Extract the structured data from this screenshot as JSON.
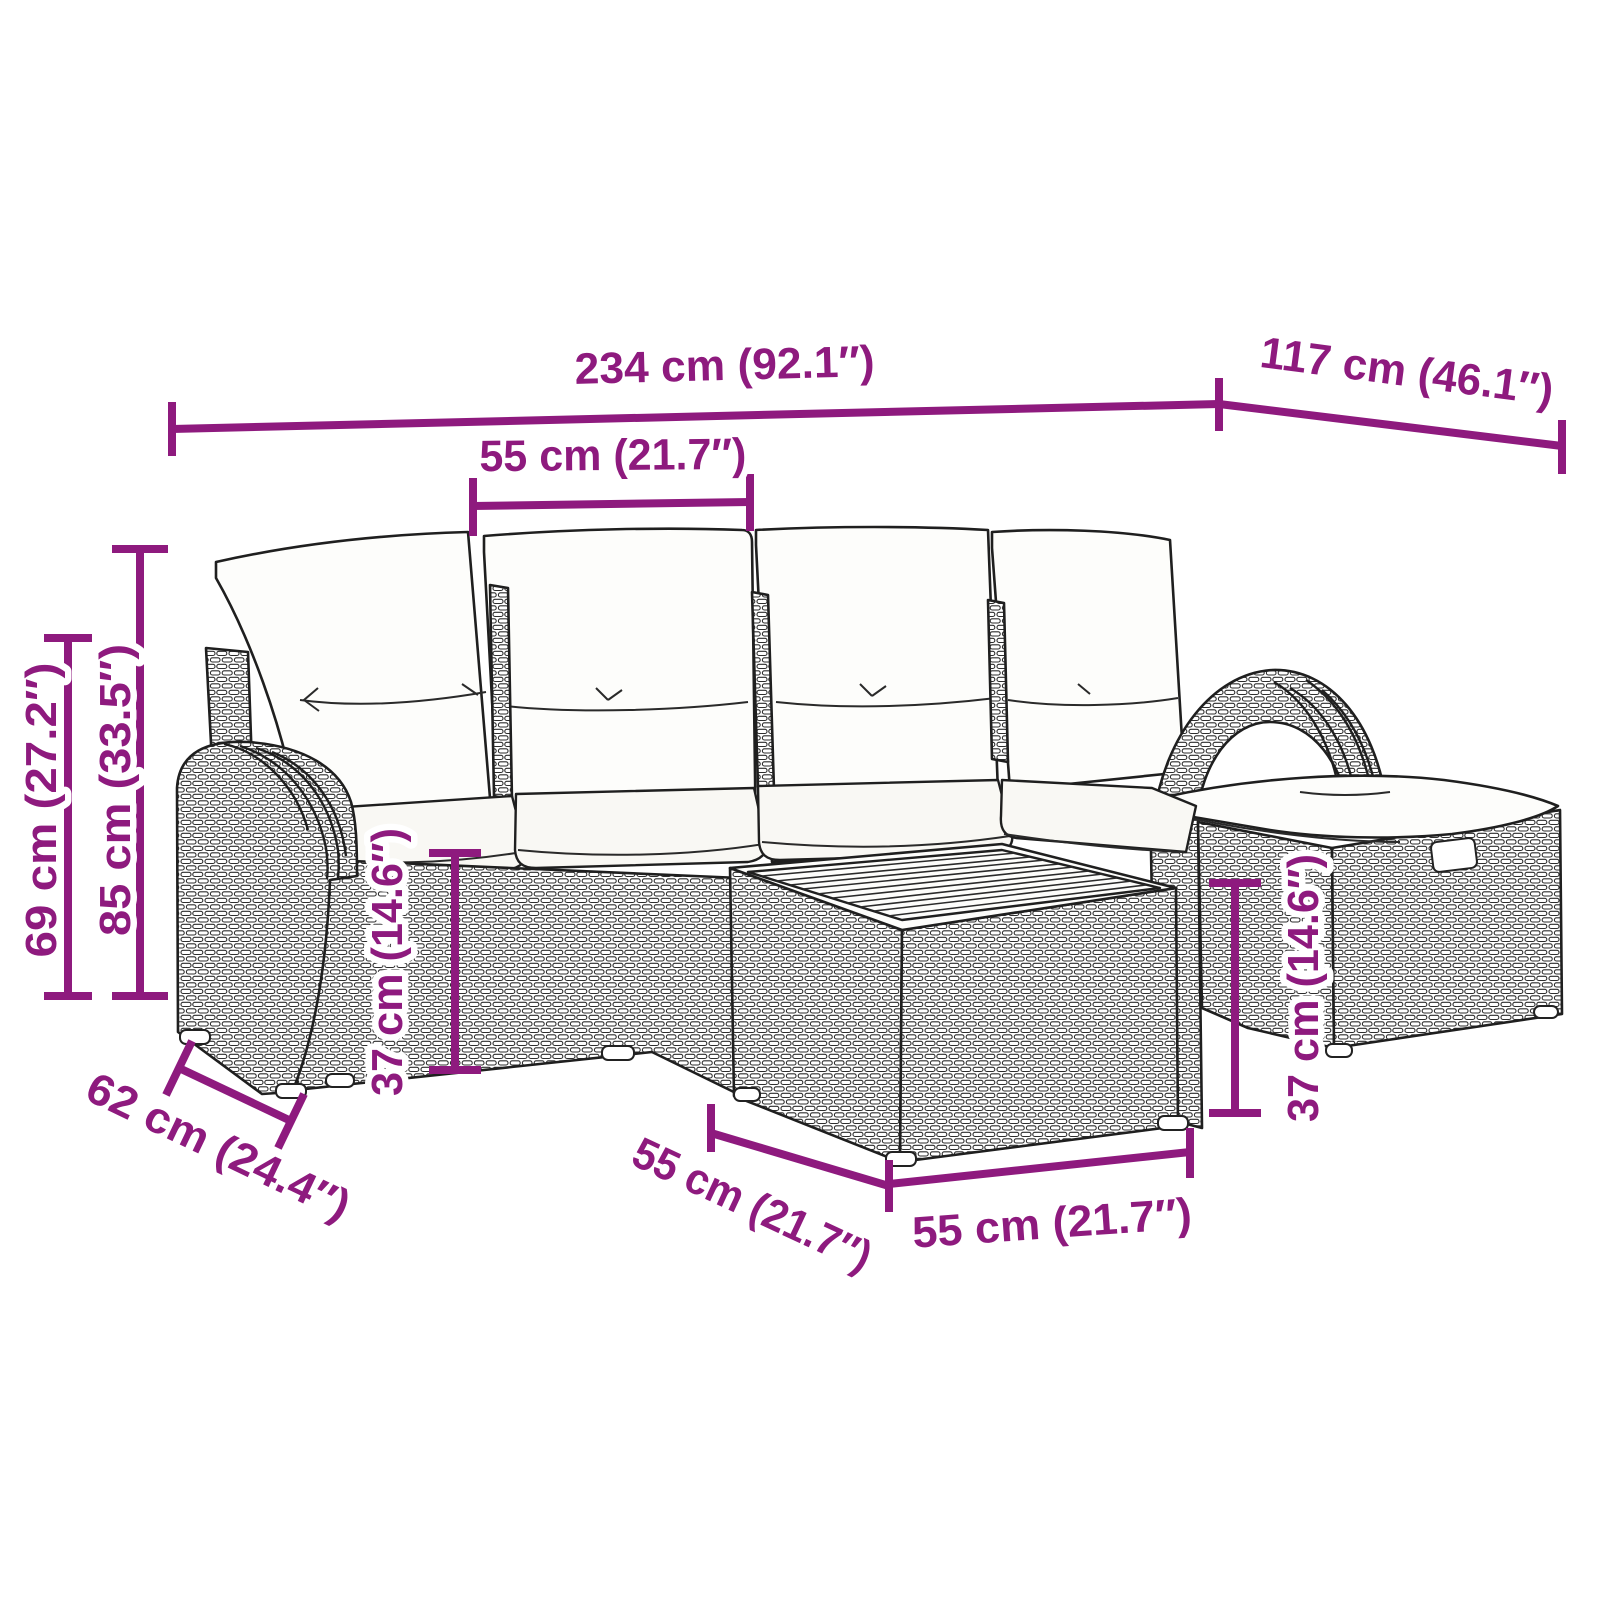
{
  "diagram": {
    "kind": "product-dimension-diagram",
    "subject": "rattan garden lounge set with cushions, ottoman and coffee table",
    "style": "black line-art drawing with magenta dimension annotations on white",
    "accent_color": "#8E1A7E",
    "line_color": "#1f1f1f",
    "background_color": "#ffffff"
  },
  "dims": {
    "total_width": "234 cm (92.1″)",
    "total_depth": "117 cm (46.1″)",
    "seat_width": "55 cm (21.7″)",
    "back_height": "85 cm (33.5″)",
    "arm_height": "69 cm (27.2″)",
    "seat_height_left": "37 cm (14.6″)",
    "arm_depth": "62 cm (24.4″)",
    "table_depth": "55 cm (21.7″)",
    "table_width": "55 cm (21.7″)",
    "seat_height_right": "37 cm (14.6″)"
  }
}
